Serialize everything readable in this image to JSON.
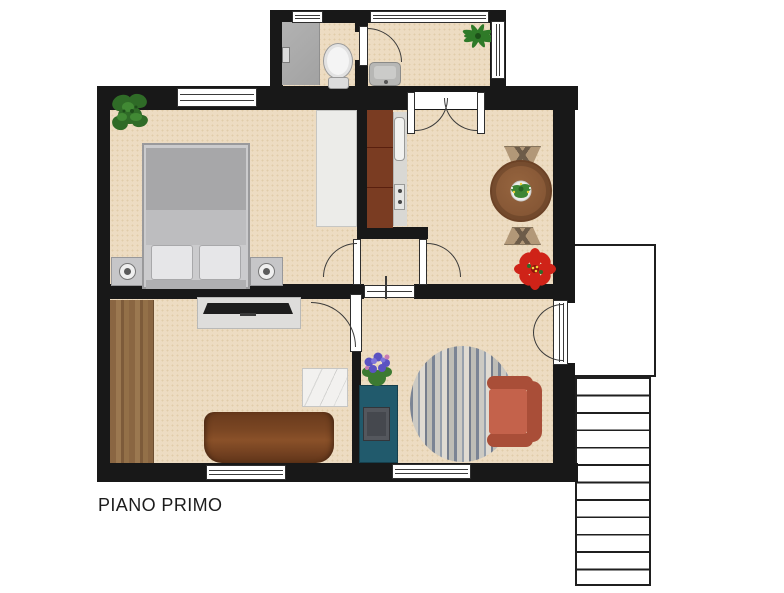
{
  "title": "PIANO PRIMO",
  "floor_label": "PIANO PRIMO",
  "colors": {
    "wall": "#181818",
    "floor": "#eddcc2",
    "floor-dot": "#e1cda9",
    "stroke": "#3a3a3a",
    "white-fix": "#f4f4f4",
    "cabinet": "#7a3c22",
    "countertop": "#d9d8d4",
    "wardrobe": "#ecece9",
    "bed-frame": "#cbcbcd",
    "duvet": "#a7a7a9",
    "pillow": "#e6e6e8",
    "tvstand": "#dedddb",
    "tv": "#1d1d1d",
    "marble": "#f2f1ef",
    "teal": "#215a6c",
    "armchair": "#c4624b",
    "armchair-dark": "#a94e38"
  },
  "rooms": [
    "bathroom",
    "entry-hallway",
    "bedroom",
    "kitchen",
    "dining-area",
    "living-room",
    "study-room"
  ],
  "furniture": [
    "shower",
    "toilet",
    "sink",
    "double-bed",
    "nightstand",
    "lamp",
    "wardrobe",
    "kitchen-counter",
    "sink-unit",
    "stove",
    "dining-table",
    "dining-chairs",
    "tv-stand",
    "tv",
    "sofa",
    "coffee-table",
    "desk",
    "laptop",
    "armchair",
    "rug",
    "stair-landing",
    "staircase"
  ],
  "plants": [
    "bedroom-plant",
    "entry-plant",
    "table-centerpiece",
    "poinsettia",
    "purple-flower-plant"
  ]
}
